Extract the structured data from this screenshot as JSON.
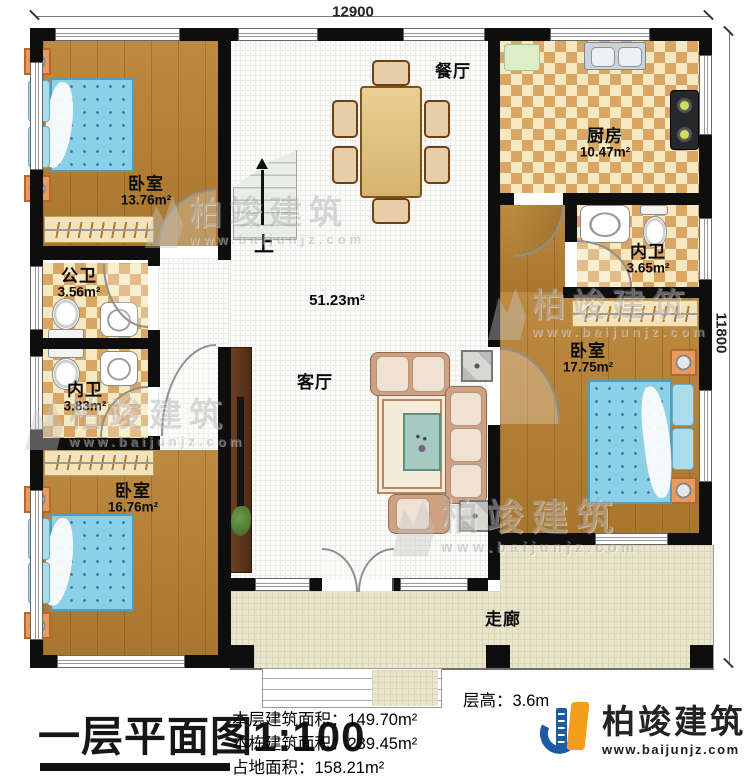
{
  "plan": {
    "dimensions": {
      "width_mm": "12900",
      "height_mm": "11800"
    },
    "rooms": {
      "bedroom_top_left": {
        "label": "卧室",
        "area": "13.76m²"
      },
      "dining": {
        "label": "餐厅"
      },
      "kitchen": {
        "label": "厨房",
        "area": "10.47m²"
      },
      "bath_ensuite_right": {
        "label": "内卫",
        "area": "3.65m²"
      },
      "bedroom_right": {
        "label": "卧室",
        "area": "17.75m²"
      },
      "bath_public": {
        "label": "公卫",
        "area": "3.56m²"
      },
      "bath_ensuite_left": {
        "label": "内卫",
        "area": "3.83m²"
      },
      "bedroom_bottom_left": {
        "label": "卧室",
        "area": "16.76m²"
      },
      "living": {
        "label": "客厅",
        "area": "51.23m²"
      },
      "corridor": {
        "label": "走廊"
      },
      "stairs": {
        "label": "上"
      }
    },
    "title_block": {
      "title": "一层平面图",
      "scale": "1:100",
      "floor_height": "层高：3.6m",
      "floor_area": "本层建筑面积：149.70m²",
      "building_area": "本栋建筑面积：239.45m²",
      "footprint_area": "占地面积：158.21m²"
    },
    "brand": {
      "name": "柏竣建筑",
      "website": "www.baijunjz.com"
    },
    "watermark": {
      "name": "柏竣建筑",
      "website": "www.baijunjz.com"
    },
    "colors": {
      "wall": "#0e0e0e",
      "wood_floor": "#b28038",
      "tile_accent": "#d9a663",
      "bed_blue": "#8bd0e6",
      "brand_blue": "#1d5ca5",
      "brand_orange": "#f59e1c"
    }
  }
}
